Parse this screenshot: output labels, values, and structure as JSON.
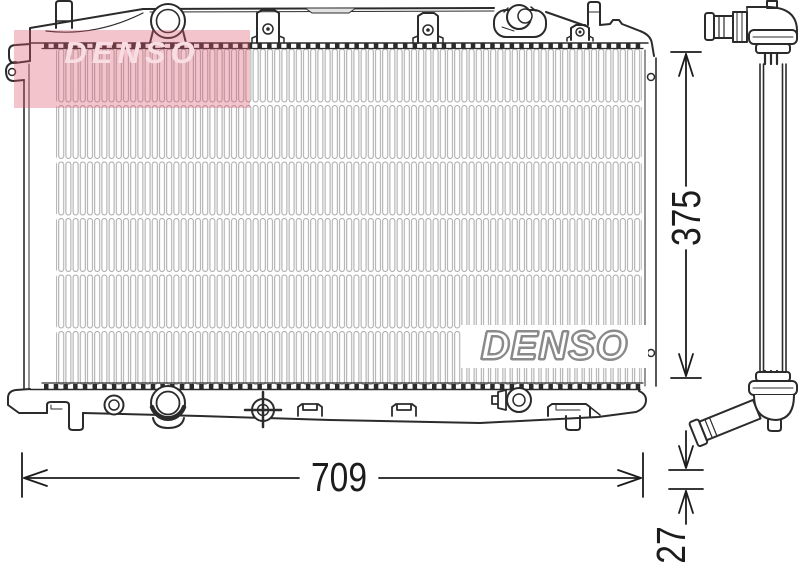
{
  "figure": {
    "kind": "radiator technical line drawing",
    "views": [
      "front",
      "side-profile"
    ]
  },
  "brand": {
    "core_logo": "DENSO",
    "watermark": "DENSO"
  },
  "dimensions": {
    "width": "709",
    "height": "375",
    "depth": "27"
  },
  "colors": {
    "background": "#ffffff",
    "line": "#2b2b2b",
    "fin_line": "#a6a6a6",
    "dimension_text": "#1c1c1c",
    "watermark_pink": "rgba(224,85,112,0.35)",
    "watermark_text": "#f8dde3",
    "logo_outline": "#8a8a8a"
  }
}
